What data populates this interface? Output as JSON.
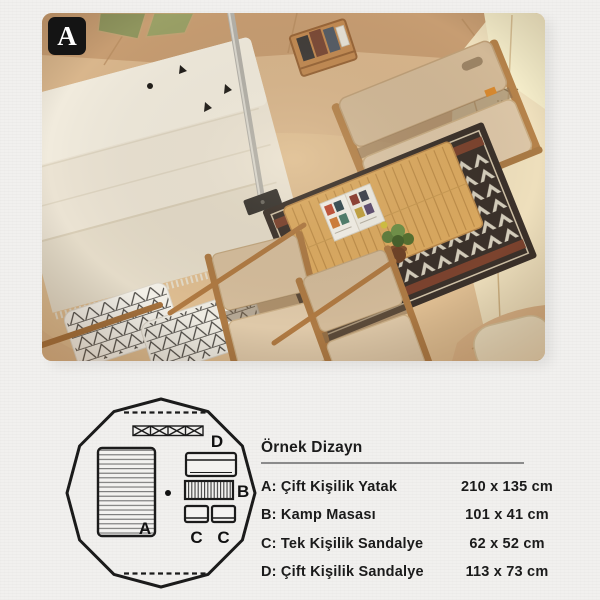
{
  "photo": {
    "badge_label": "A"
  },
  "diagram": {
    "bed_label": "A",
    "table_label": "B",
    "chair_left_label": "C",
    "chair_right_label": "C",
    "bench_label": "D"
  },
  "legend": {
    "title": "Örnek Dizayn",
    "items": [
      {
        "label": "A: Çift Kişilik Yatak",
        "size": "210 x 135 cm"
      },
      {
        "label": "B: Kamp Masası",
        "size": "101 x 41 cm"
      },
      {
        "label": "C: Tek Kişilik Sandalye",
        "size": "62 x 52 cm"
      },
      {
        "label": "D: Çift Kişilik Sandalye",
        "size": "113 x 73 cm"
      }
    ]
  },
  "colors": {
    "page_background": "#f1f0ee",
    "badge_background": "#141414",
    "badge_text": "#ffffff",
    "diagram_line": "#1b1b1b",
    "divider_gray": "#8b8b8b",
    "text": "#1b1b1b",
    "tent_tan": "#d9b68c",
    "canvas_beige": "#d8c2a3",
    "bedding_white": "#ece4d4",
    "rug_dark": "#3b312a",
    "wood_brown": "#b5824a",
    "mesh_olive": "#8f955e"
  }
}
